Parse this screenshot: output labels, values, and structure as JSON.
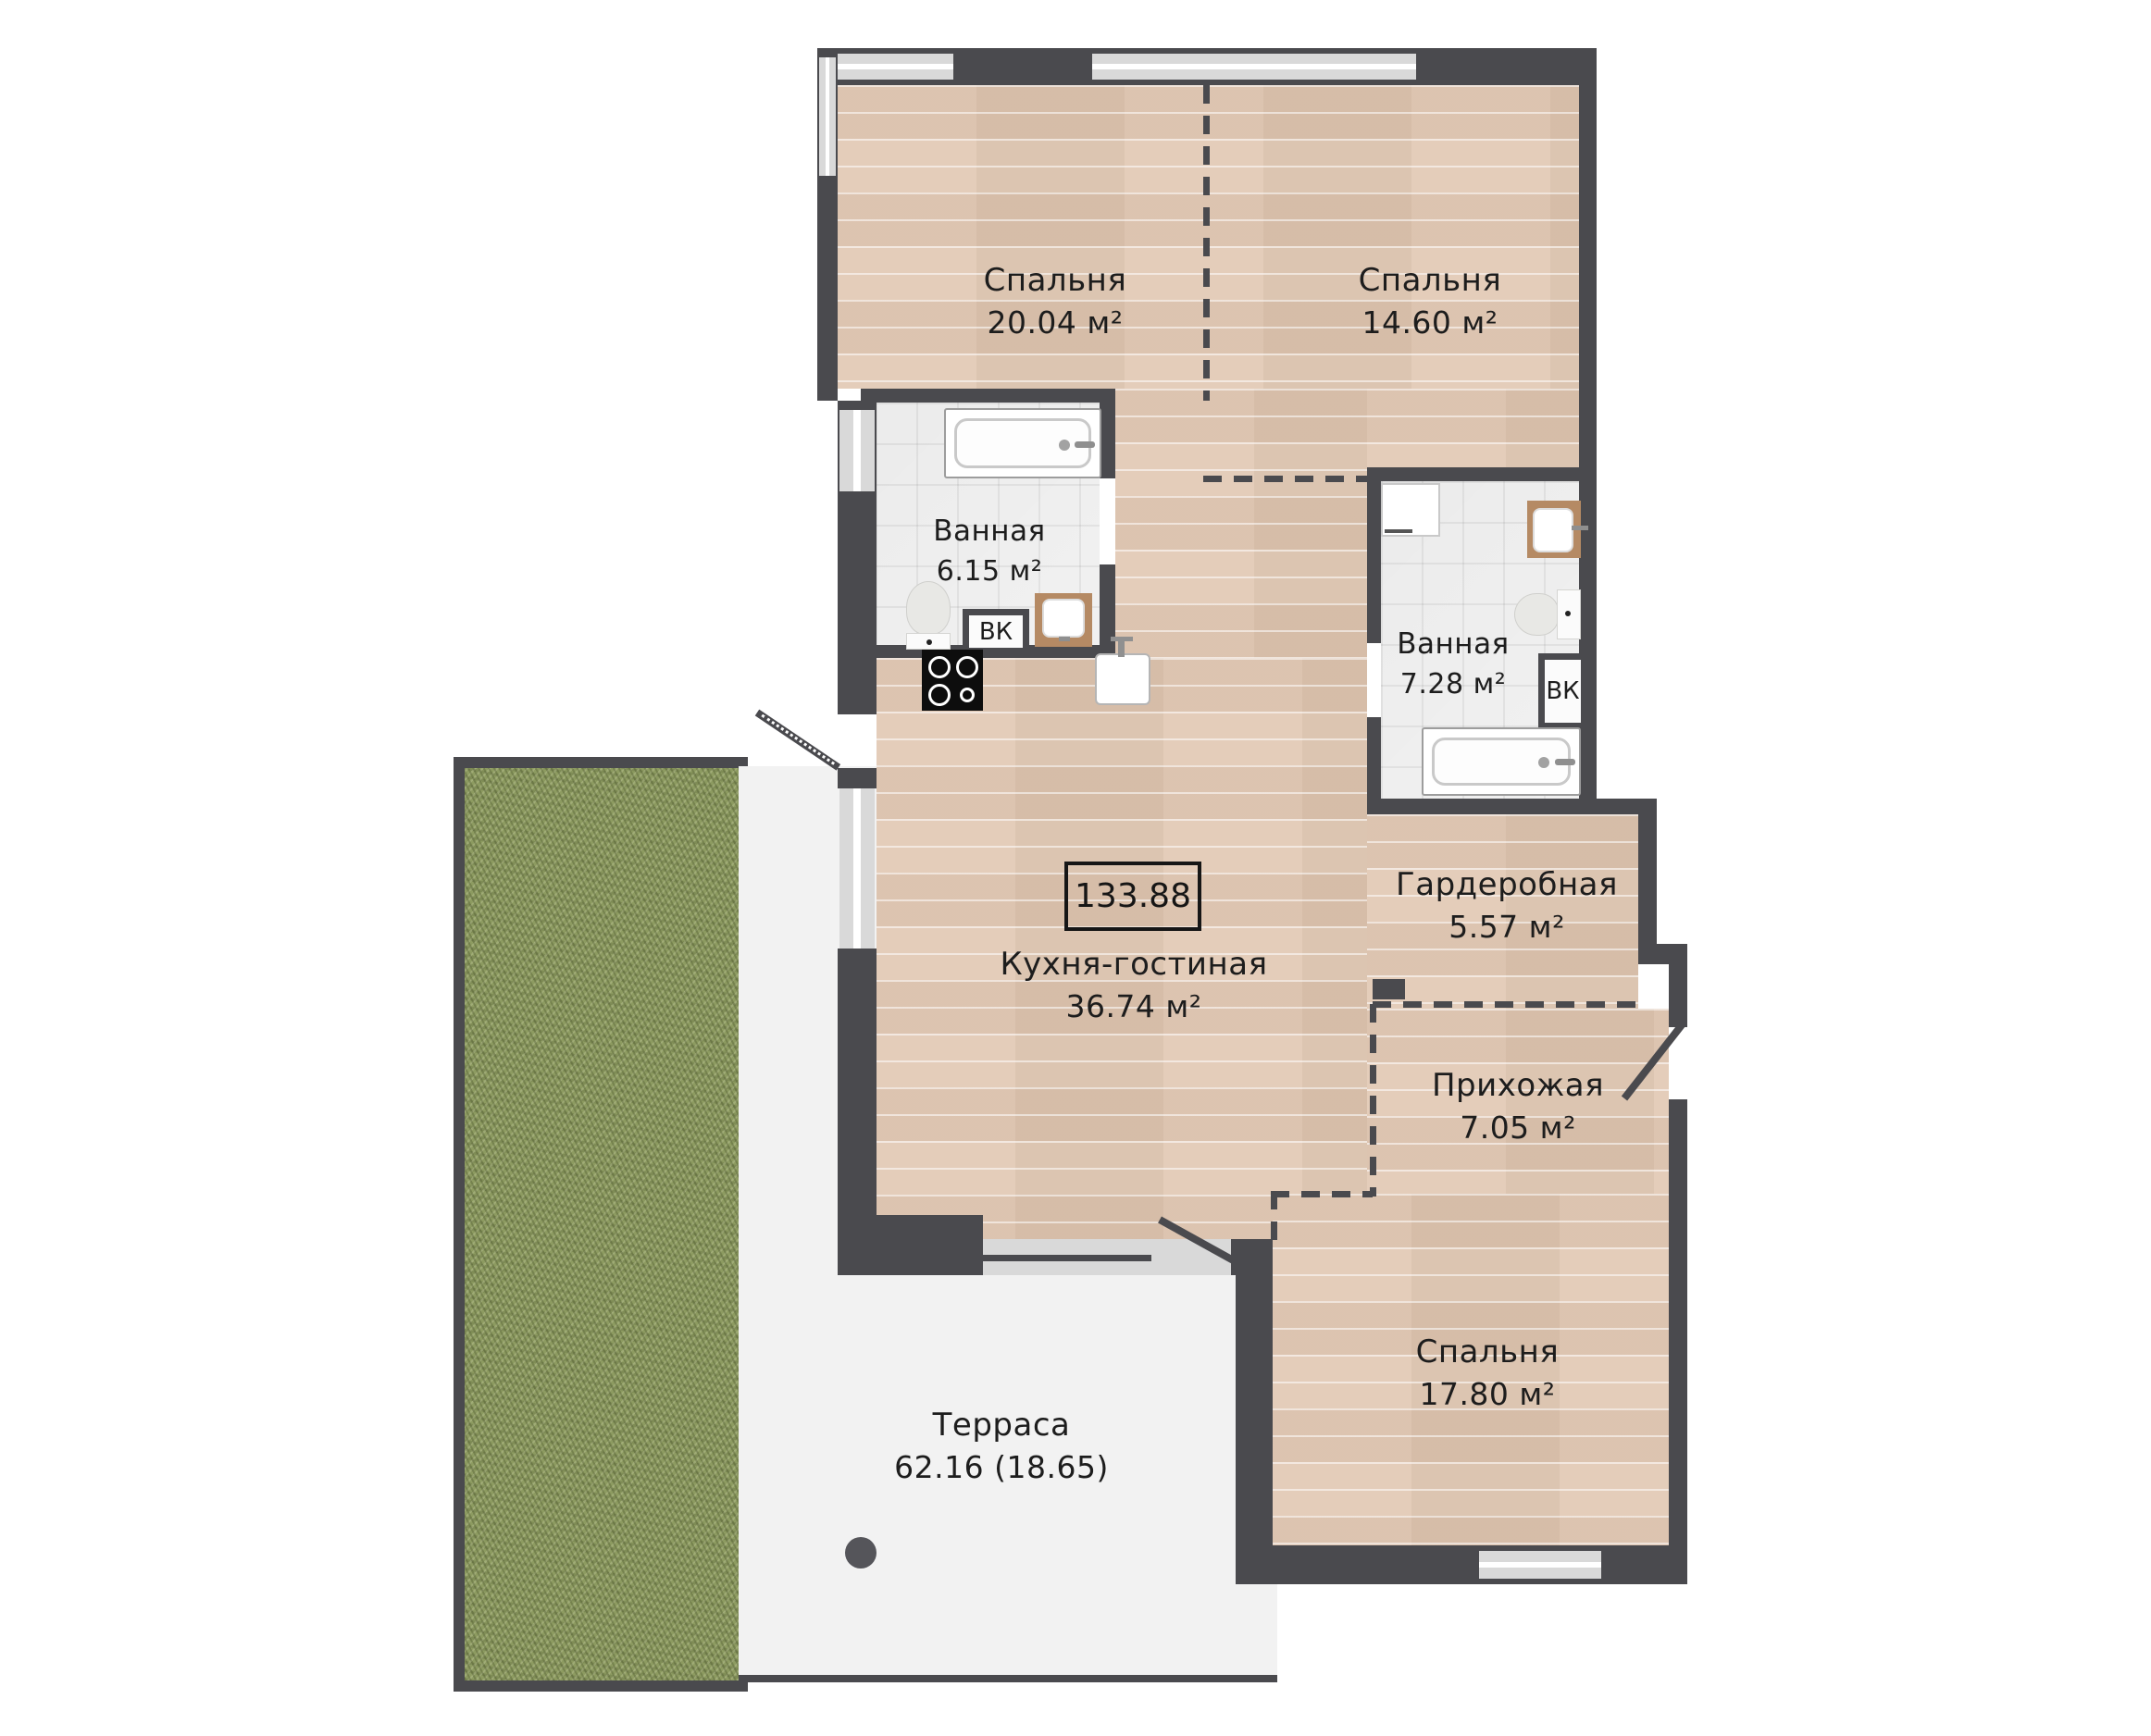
{
  "colors": {
    "wall": "#4a4a4e",
    "window": "#d9d9d9",
    "wood": "#e9d3c0",
    "tile": "#f1f1f1",
    "grass": "#8d9b61",
    "terrace": "#f2f2f2",
    "text": "#1d1d1d",
    "fixture": "#b5b5b5"
  },
  "total_area": "133.88",
  "shaft_label": "ВК",
  "rooms": {
    "bedroom1": {
      "name": "Спальня",
      "area": "20.04 м²"
    },
    "bedroom2": {
      "name": "Спальня",
      "area": "14.60 м²"
    },
    "bathroom1": {
      "name": "Ванная",
      "area": "6.15 м²"
    },
    "bathroom2": {
      "name": "Ванная",
      "area": "7.28 м²"
    },
    "kitchen_living": {
      "name": "Кухня-гостиная",
      "area": "36.74 м²"
    },
    "wardrobe": {
      "name": "Гардеробная",
      "area": "5.57 м²"
    },
    "hallway": {
      "name": "Прихожая",
      "area": "7.05 м²"
    },
    "bedroom3": {
      "name": "Спальня",
      "area": "17.80 м²"
    },
    "terrace": {
      "name": "Терраса",
      "area": "62.16 (18.65)"
    }
  }
}
